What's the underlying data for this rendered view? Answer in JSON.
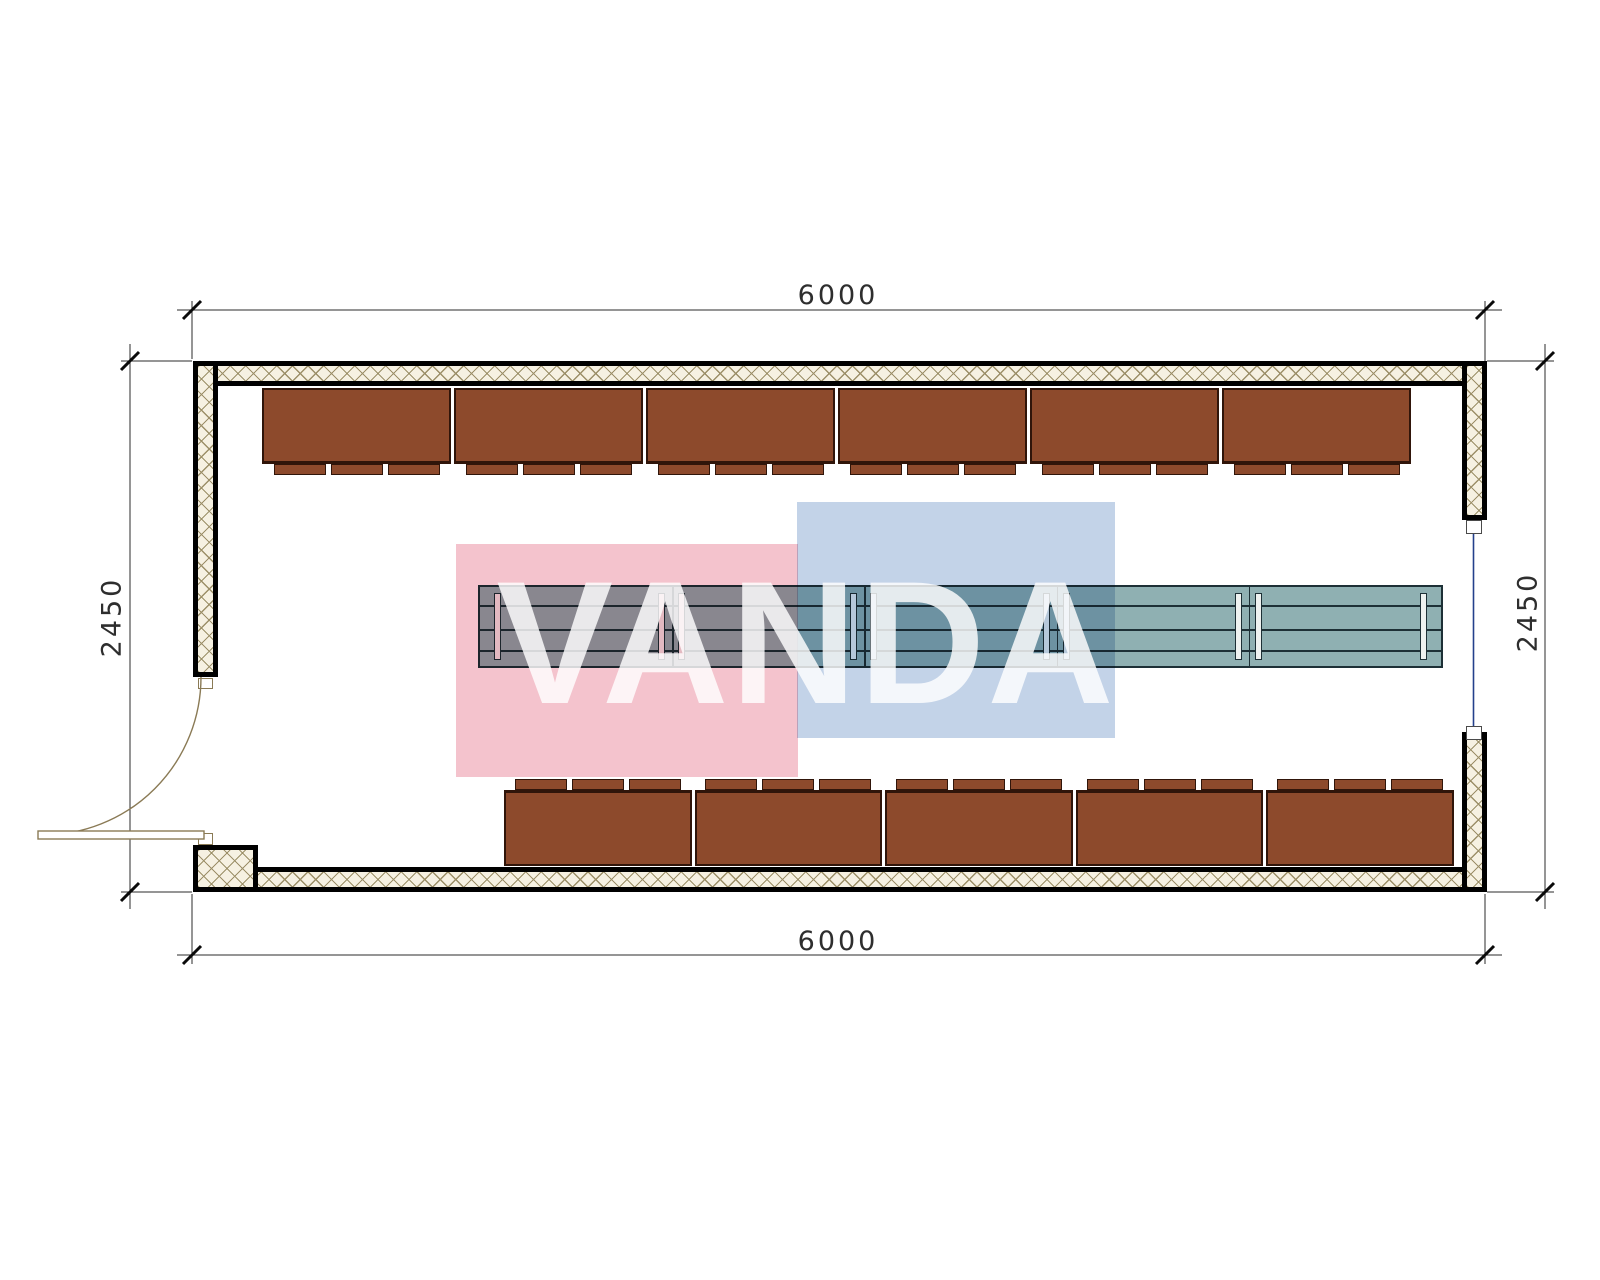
{
  "dimensions": {
    "top": "6000",
    "bottom": "6000",
    "left": "2450",
    "right": "2450"
  },
  "watermark": {
    "text": "VANDA",
    "pink_color": "#f4c3cd",
    "blue_color": "#c3d3e8",
    "text_color": "#ffffff"
  },
  "plan": {
    "walls": {
      "fill": "#f6f1e2",
      "hatch": "#9c8f68",
      "outline": "#000000"
    },
    "seating": {
      "top_row_count": 6,
      "bottom_row_count": 5,
      "tabs_per_bench": 3,
      "color": "#8d4a2c"
    },
    "table": {
      "module_count": 5,
      "fill": "#8fb0b2",
      "outline": "#1d3036"
    },
    "door": {
      "count": 1,
      "color": "#8a7a55"
    },
    "window": {
      "count": 1,
      "glazing_color": "#24408c"
    }
  }
}
